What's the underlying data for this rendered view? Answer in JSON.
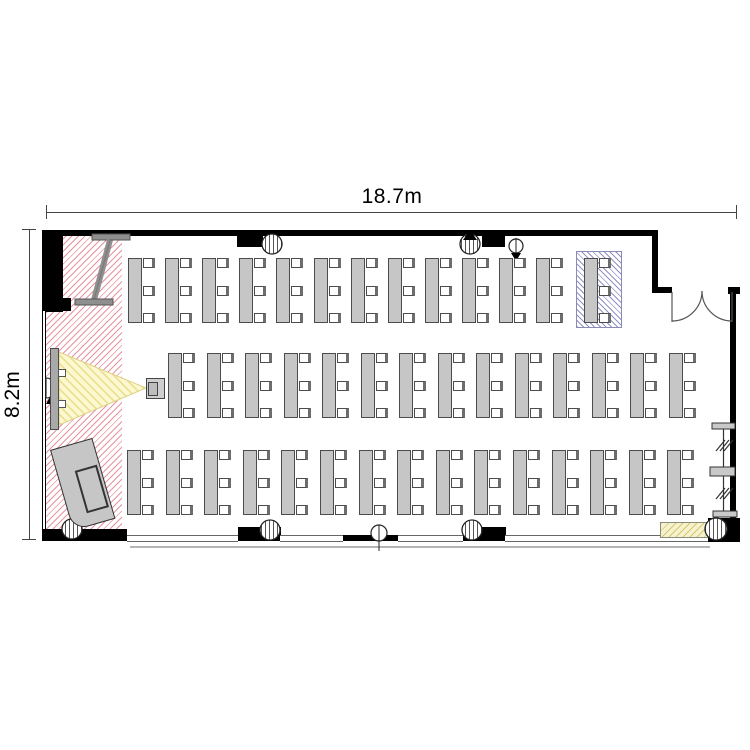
{
  "room": {
    "width_label": "18.7m",
    "height_label": "8.2m",
    "type": "seminar-room-floor-plan"
  },
  "colors": {
    "wall": "#000000",
    "furniture_fill": "#c6c6c6",
    "stage_hatch": "#e07a8c",
    "highlight_hatch": "#7d7dbe",
    "projection_cone_fill": "#fcf8d2",
    "projection_cone_line": "#e8dc82",
    "counter_fill": "#f6f2cd"
  },
  "desk_geometry": {
    "table_w": 14,
    "table_h": 65,
    "chairs_per_desk": 3,
    "chair_w": 12,
    "chair_h": 10
  },
  "desk_rows": [
    {
      "name": "front-row",
      "y": 258,
      "start_x": 128,
      "spacing": 37.1,
      "count": 12
    },
    {
      "name": "middle-row",
      "y": 353,
      "start_x": 168,
      "spacing": 38.5,
      "count": 14
    },
    {
      "name": "back-row",
      "y": 450,
      "start_x": 127,
      "spacing": 38.6,
      "count": 15
    }
  ],
  "highlighted_desk": {
    "x": 584,
    "y": 258,
    "frame": {
      "x": 576,
      "y": 251,
      "w": 46,
      "h": 77
    }
  },
  "icons": {
    "projection-screen": "vertical-bar",
    "projector": "box-with-lens",
    "light-cone": "yellow-triangle-hatch",
    "whiteboard-stand": "i-beam",
    "teacher-desk": "rotated-rectangle",
    "double-door": "double-swing-arcs",
    "movable-partition": "track-with-stops",
    "column": "striped-circle",
    "ceiling-fixture": "striped-circle",
    "speaker-marker": "black-triangle",
    "counter": "hatched-rectangle"
  }
}
